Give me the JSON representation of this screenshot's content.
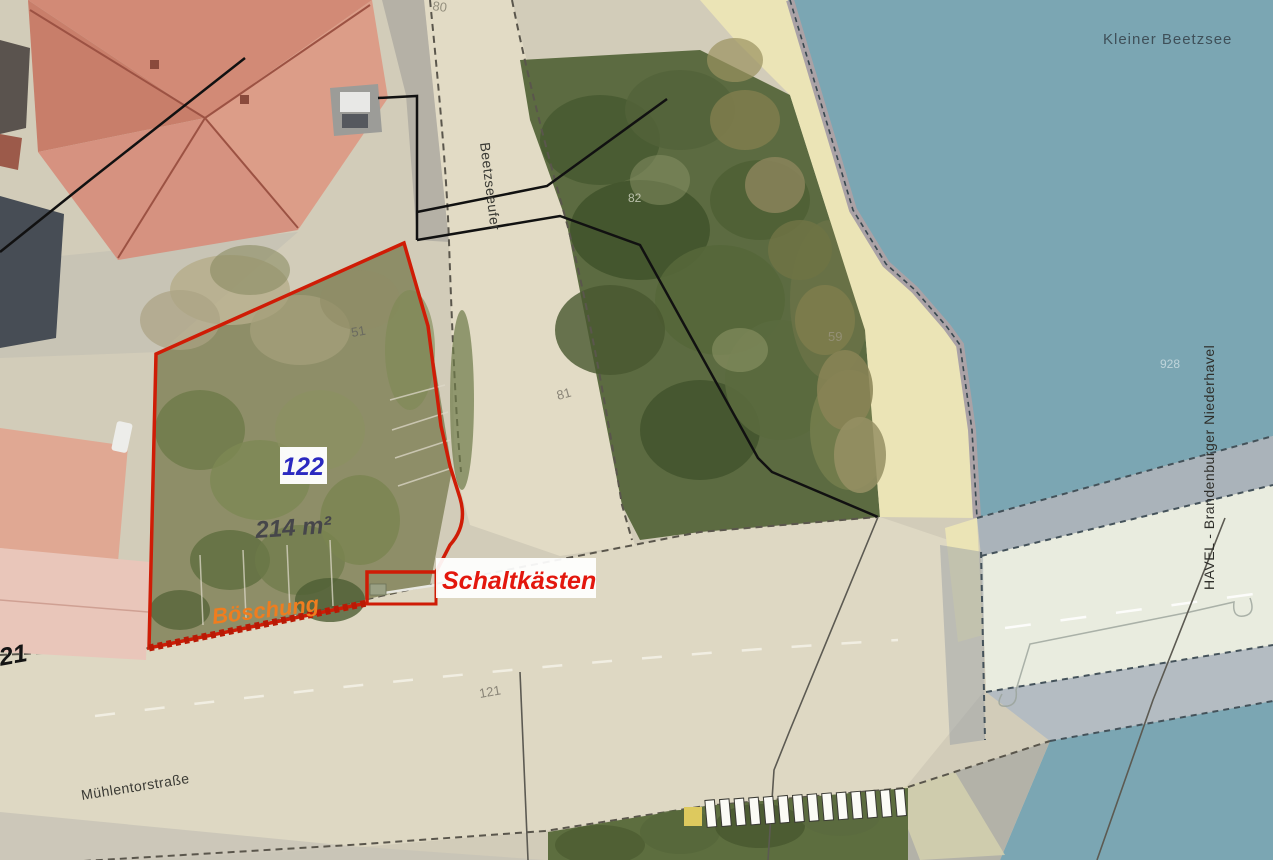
{
  "water": {
    "kleiner_beetzsee": "Kleiner Beetzsee",
    "havel": "HAVEL - Brandenburger Niederhavel",
    "gauge_number": "928"
  },
  "streets": {
    "beetzseeufer": "Beetzseeufer",
    "muehlentorstrasse": "Mühlentorstraße",
    "road_number": "121"
  },
  "parcel": {
    "number": "122",
    "area": "214 m²",
    "embankment": "Böschung",
    "switch_boxes": "Schaltkästen"
  },
  "plot_numbers": {
    "n51": "51",
    "n80": "80",
    "n82": "82",
    "n81": "81",
    "n59": "59",
    "building_121": "121"
  },
  "colors": {
    "water": "#7BA6B3",
    "parcel_outline": "#CF1C06",
    "label_red": "#E3170D",
    "label_orange": "#EF7D1F",
    "label_blue": "#2B29C0",
    "promenade": "#EBE4B6",
    "road": "#DED8C3",
    "vegetation": "#5C6B41"
  }
}
